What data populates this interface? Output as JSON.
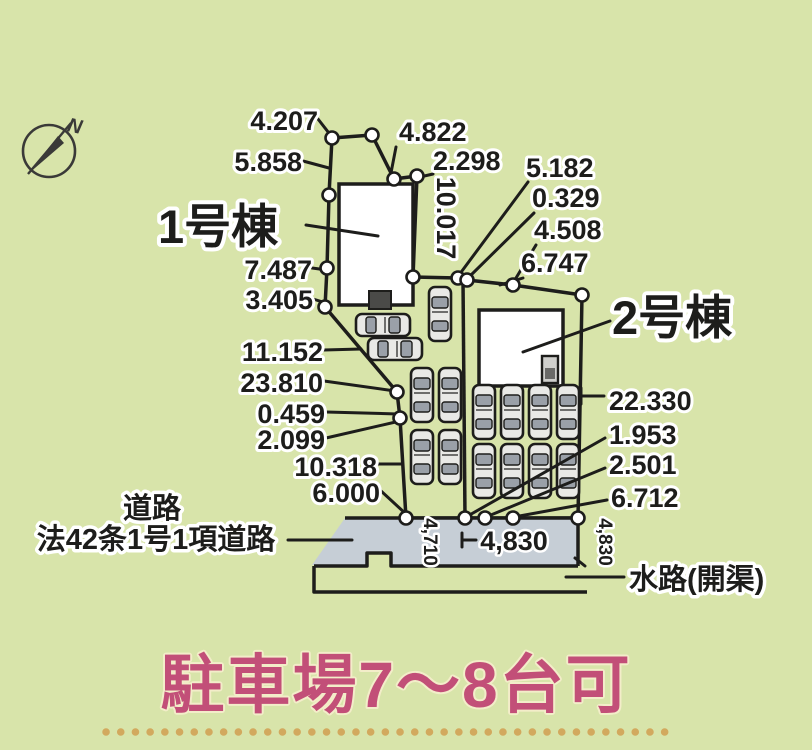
{
  "colors": {
    "background": "#d8e4aa",
    "parcel": "#f1edda",
    "road": "#c6ced6",
    "building": "#ffffff",
    "line": "#1d1d1b",
    "caption_pink": "#c24f78",
    "dot_orange": "#d2a95e"
  },
  "compass": {
    "north": "N"
  },
  "plan": {
    "building1": "1号棟",
    "building2": "2号棟",
    "dims": {
      "a4207": "4.207",
      "a5858": "5.858",
      "a7487": "7.487",
      "a3405": "3.405",
      "a11152": "11.152",
      "a23810": "23.810",
      "a0459": "0.459",
      "a2099": "2.099",
      "a10318": "10.318",
      "a6000": "6.000",
      "a4822": "4.822",
      "a2298": "2.298",
      "a10017": "10.017",
      "a5182": "5.182",
      "a0329": "0.329",
      "a4508": "4.508",
      "a6747": "6.747",
      "a22330": "22.330",
      "a1953": "1.953",
      "a2501": "2.501",
      "a6712": "6.712",
      "b4710": "4,710",
      "b4830": "4,830",
      "b4830v": "4,830"
    },
    "road_label_1": "道路",
    "road_label_2": "法42条1号1項道路",
    "waterway_label": "水路(開渠)"
  },
  "caption": "駐車場7～8台可"
}
